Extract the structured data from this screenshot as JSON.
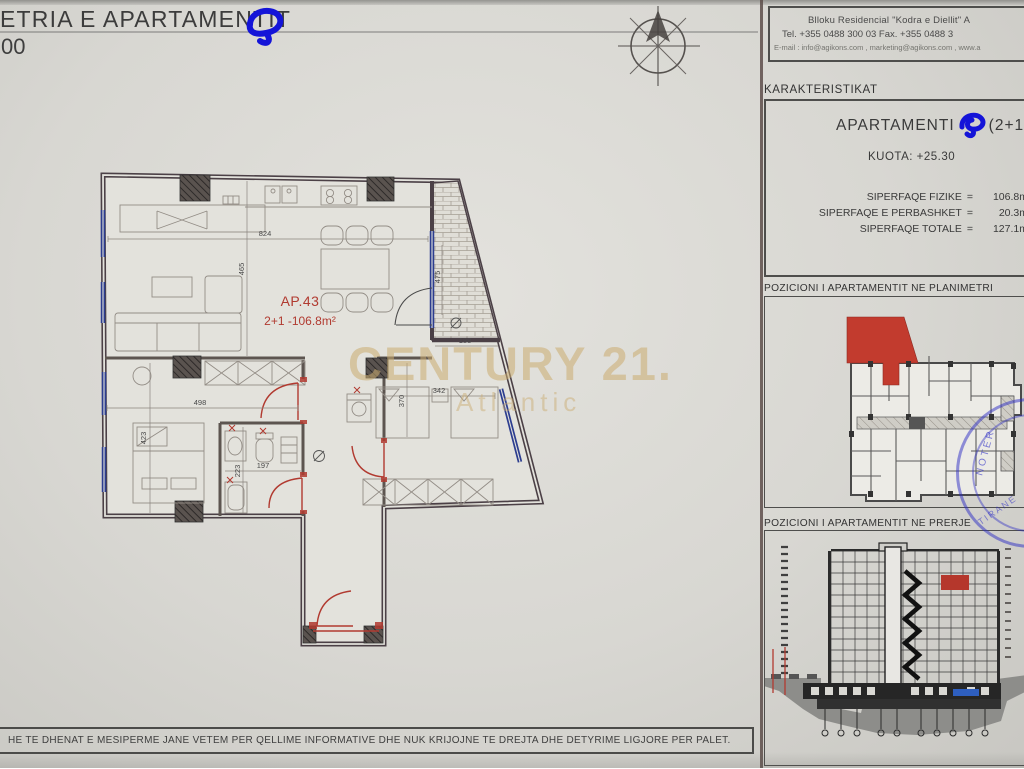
{
  "title": {
    "main": "ETRIA E APARTAMENTIT",
    "scale_fragment": "00"
  },
  "company": {
    "line1": "Blloku Residencial \"Kodra e Diellit\" A",
    "line2": "Tel. +355 0488 300 03   Fax. +355 0488 3",
    "line3": "E-mail : info@agikons.com , marketing@agikons.com , www.a"
  },
  "characteristics": {
    "header": "KARAKTERISTIKAT",
    "apartment_label": "APARTAMENTI",
    "apartment_type": "(2+1",
    "kuota": "KUOTA: +25.30",
    "rows": [
      {
        "label": "SIPERFAQE  FIZIKE",
        "eq": "=",
        "value": "106.8m"
      },
      {
        "label": "SIPERFAQE E PERBASHKET",
        "eq": "=",
        "value": "20.3m"
      },
      {
        "label": "SIPERFAQE TOTALE",
        "eq": "=",
        "value": "127.1m"
      }
    ]
  },
  "positions": {
    "planimetri_header": "POZICIONI I APARTAMENTIT NE PLANIMETRI",
    "prerje_header": "POZICIONI I APARTAMENTIT NE PRERJE"
  },
  "floorplan": {
    "ap_label": "AP.43",
    "area_label": "2+1 -106.8m²",
    "dims": {
      "living_width": "824",
      "living_height": "465",
      "balcony_width": "188",
      "balcony_height": "475",
      "bedroom1_width": "498",
      "bedroom1_height": "423",
      "bath_width": "197",
      "bath_height": "223",
      "bedroom2_width": "342",
      "bedroom2_height": "370"
    }
  },
  "watermark": {
    "brand": "CENTURY 21.",
    "sub": "Atlantic"
  },
  "stamp": {
    "line1": "NOTER",
    "line2": "TIRANE"
  },
  "disclaimer": "HE TE DHENAT E MESIPERME JANE VETEM PER QELLIME INFORMATIVE DHE NUK KRIJOJNE TE DREJTA DHE DETYRIME LIGJORE PER PALET.",
  "colors": {
    "highlight_red": "#b13a30",
    "marker_blue": "#1414d8",
    "window_blue": "#2c3d8f",
    "wall_dark": "#4b4046",
    "watermark_gold": "#caab70",
    "stamp_blue": "#2b2bc4",
    "section_red": "#b5372c",
    "section_blue": "#2e5fc0"
  }
}
